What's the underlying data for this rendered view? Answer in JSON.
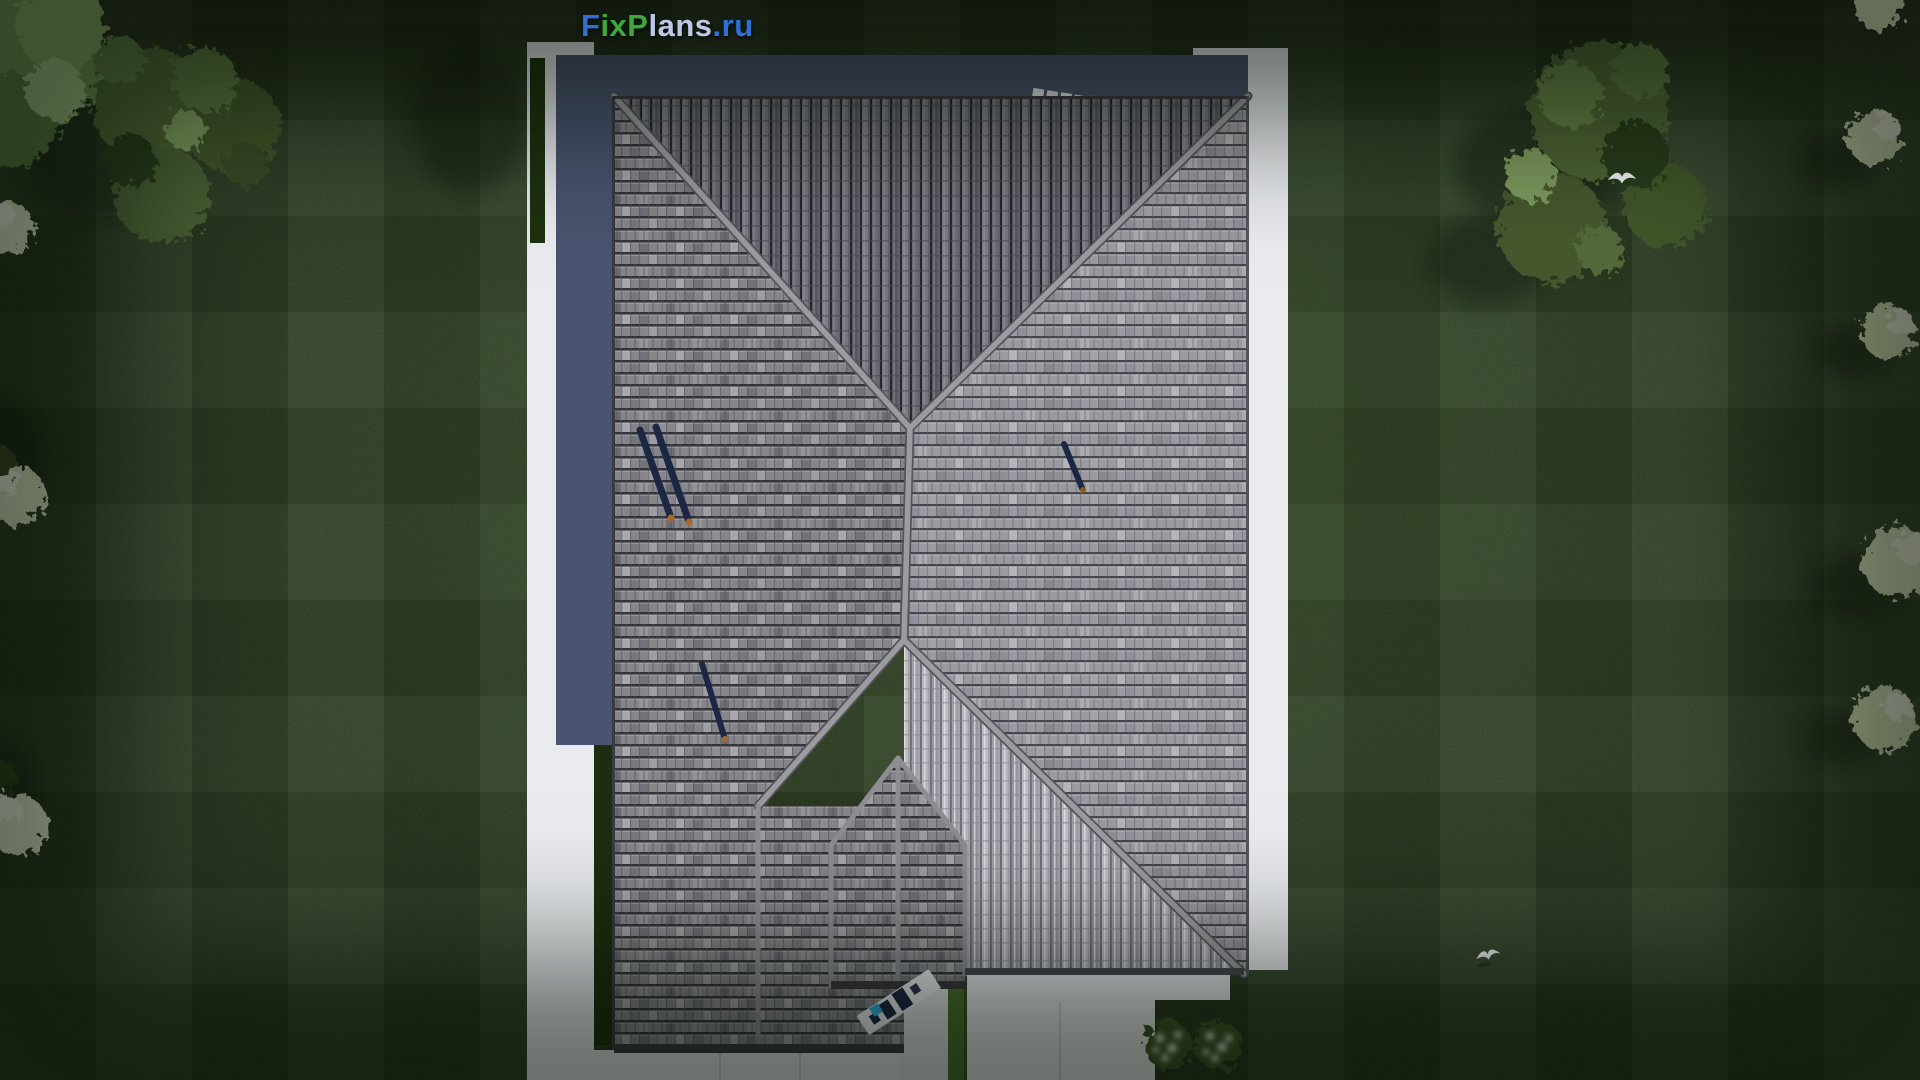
{
  "watermark": {
    "text": "FixPlans.ru",
    "segments": [
      {
        "text": "F",
        "css": "color:#2F6FD8"
      },
      {
        "text": "ix",
        "css": "color:#3FA83C"
      },
      {
        "text": "P",
        "css": "color:#3FA83C"
      },
      {
        "text": "lans",
        "css": "color:#BDC9E8"
      },
      {
        "text": ".ru",
        "css": "color:#2F6FD8"
      }
    ]
  },
  "palette": {
    "lawn_base": "#2E4420",
    "lawn_shadow": "#15220E",
    "paving_white": "#E9EBEF",
    "wall_shadow_slate": "#4A5470",
    "roof_west_slope": "#87878B",
    "roof_east_slope": "#9B9BA1",
    "roof_north_slope": "#68686F",
    "roof_south_slope": "#A5A5AC",
    "ridge_cap": "#9C9CA0",
    "eave_fascia": "#3A3A40",
    "accessory_navy": "#1C2744",
    "accessory_orange": "#A66A28",
    "accessory_blue": "#3B6ED8",
    "entry_cyan": "#2FB6E8",
    "grass_strip": "#4C7030",
    "foliage_olive": "#4F6436",
    "foliage_bright": "#86A968",
    "bush_cream": "#E3E8CC",
    "flower_white": "#F2F4EA",
    "bird_white": "#F3F5F8"
  },
  "objects": {
    "building": "hip-roof-house-top-view",
    "roof_accessories": [
      "roof-ladder",
      "snow-guard-shadow-left-pair",
      "snow-guard-shadow-left-lower",
      "snow-guard-shadow-right"
    ],
    "entry_area": [
      "entry-steps-mat",
      "entry-cyan-item",
      "grass-strip"
    ],
    "vegetation": [
      "tree-cluster-top-left",
      "tree-cluster-top-right",
      "cream-bushes-left-edge",
      "cream-bushes-right-edge",
      "flower-bushes-terrace"
    ],
    "animals": [
      "flying-bird-over-trees",
      "flying-bird-on-lawn"
    ]
  }
}
